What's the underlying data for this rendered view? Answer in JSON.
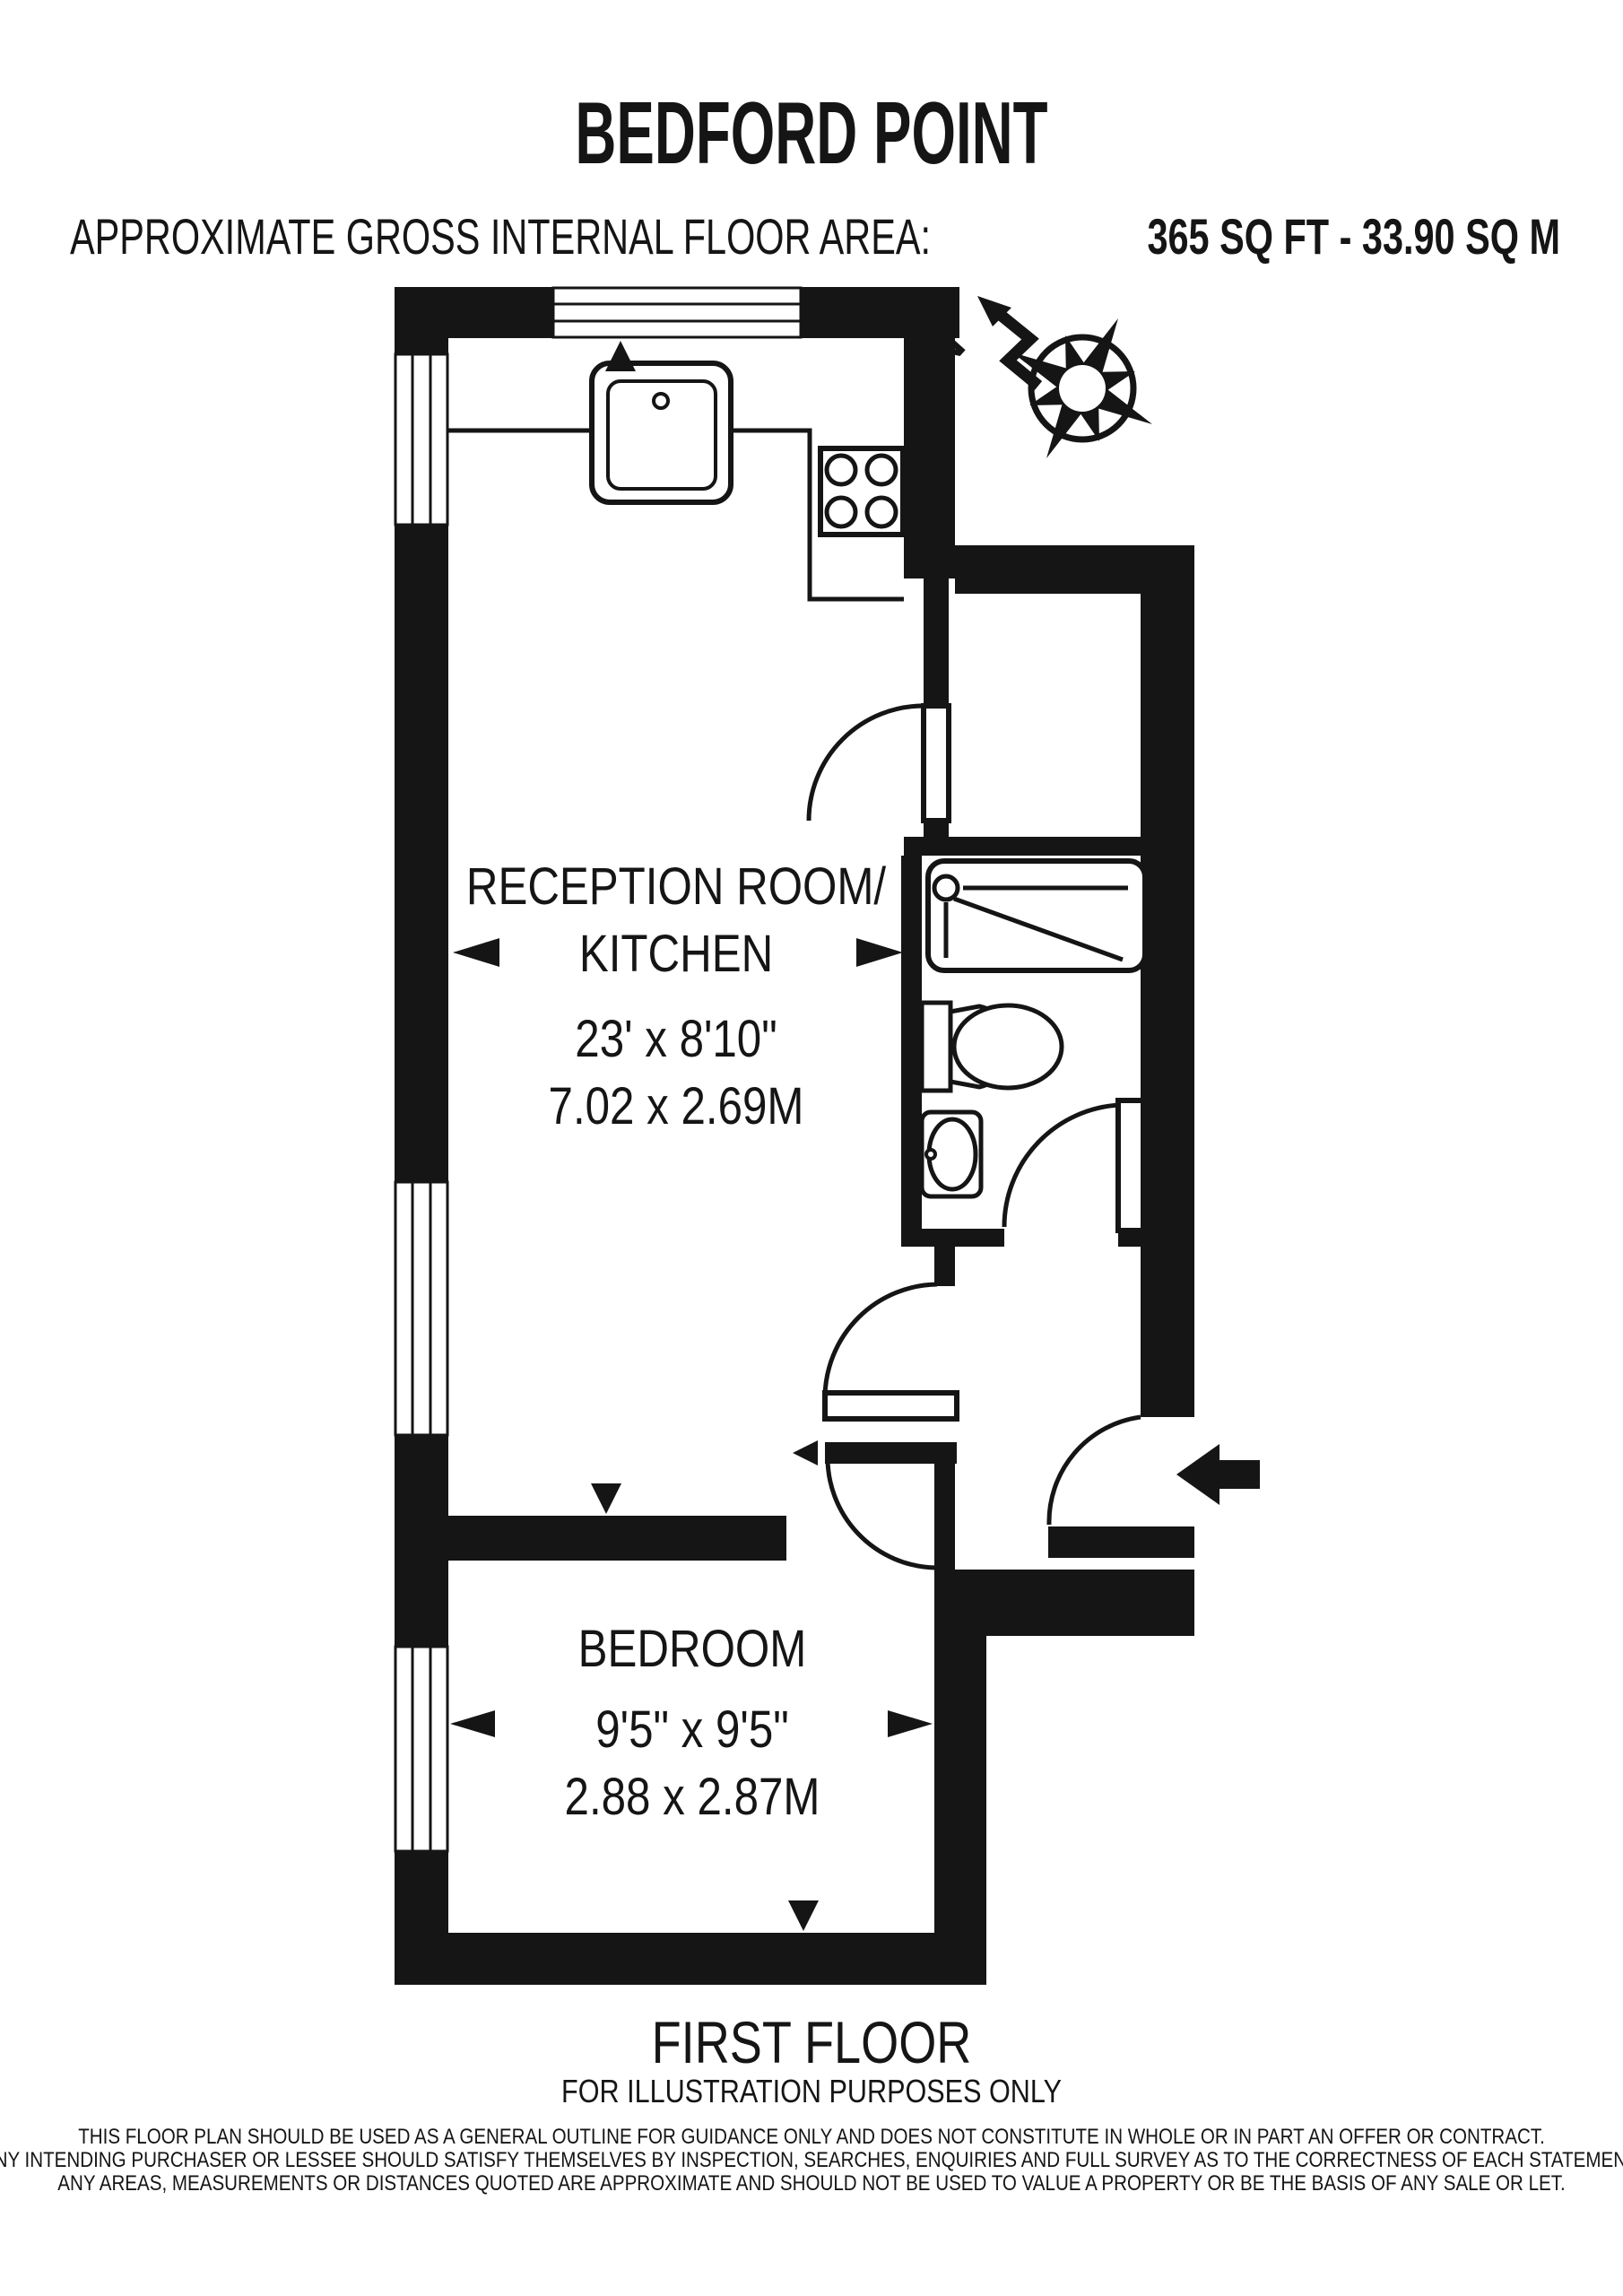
{
  "title": "BEDFORD POINT",
  "area": {
    "label": "APPROXIMATE GROSS INTERNAL FLOOR AREA:",
    "value": "365 SQ FT - 33.90 SQ M"
  },
  "compass": {
    "north": "N"
  },
  "rooms": {
    "reception": {
      "name_line1": "RECEPTION ROOM/",
      "name_line2": "KITCHEN",
      "size_imperial": "23' x 8'10\"",
      "size_metric": "7.02 x 2.69M"
    },
    "bedroom": {
      "name": "BEDROOM",
      "size_imperial": "9'5\" x 9'5\"",
      "size_metric": "2.88 x 2.87M"
    }
  },
  "floor": {
    "label": "FIRST FLOOR",
    "note": "FOR ILLUSTRATION PURPOSES ONLY"
  },
  "disclaimer": {
    "line1": "THIS FLOOR PLAN SHOULD BE USED AS A GENERAL OUTLINE FOR GUIDANCE ONLY AND DOES NOT CONSTITUTE IN WHOLE OR IN PART AN OFFER OR CONTRACT.",
    "line2": "ANY INTENDING PURCHASER OR LESSEE SHOULD SATISFY THEMSELVES BY INSPECTION, SEARCHES, ENQUIRIES AND FULL SURVEY AS TO THE CORRECTNESS OF EACH STATEMENT.",
    "line3": "ANY AREAS, MEASUREMENTS OR DISTANCES QUOTED ARE APPROXIMATE AND SHOULD NOT BE USED TO VALUE A PROPERTY OR BE THE BASIS OF ANY SALE OR LET."
  },
  "colors": {
    "ink": "#151515",
    "paper": "#ffffff"
  }
}
